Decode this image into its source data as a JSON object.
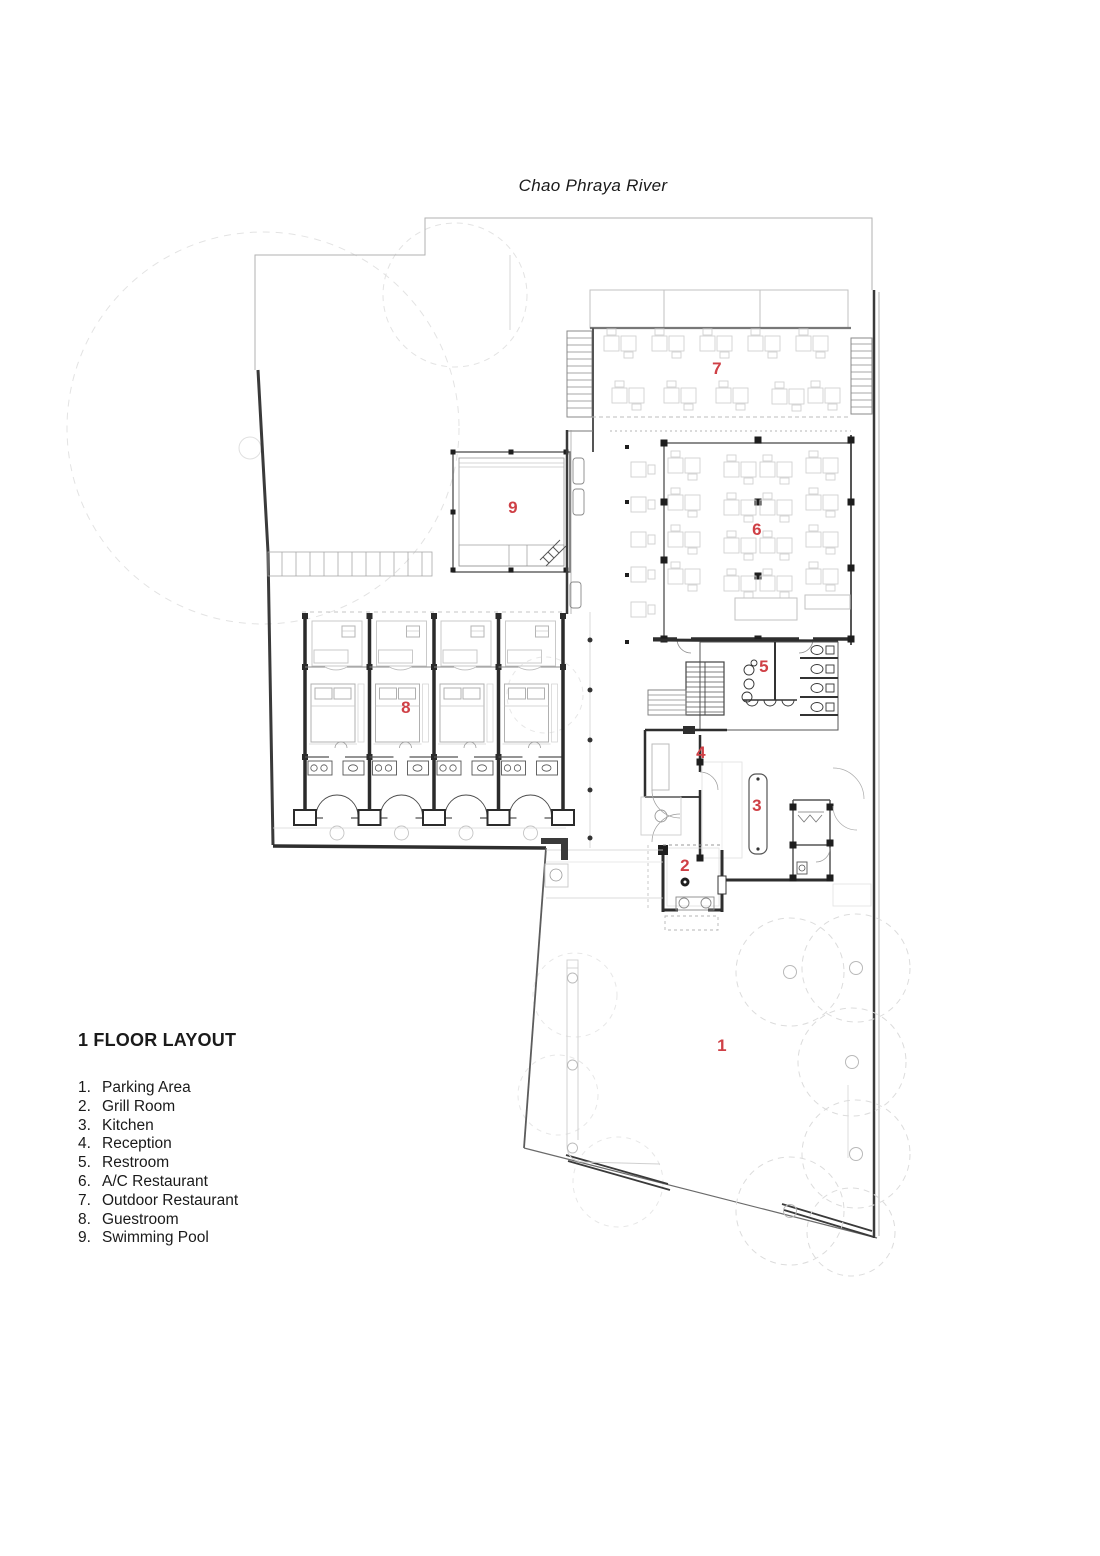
{
  "title": {
    "text": "Chao Phraya River"
  },
  "legend": {
    "heading": "1 FLOOR LAYOUT",
    "items": [
      {
        "num": "1.",
        "label": "Parking Area"
      },
      {
        "num": "2.",
        "label": "Grill Room"
      },
      {
        "num": "3.",
        "label": "Kitchen"
      },
      {
        "num": "4.",
        "label": "Reception"
      },
      {
        "num": "5.",
        "label": "Restroom"
      },
      {
        "num": "6.",
        "label": "A/C Restaurant"
      },
      {
        "num": "7.",
        "label": "Outdoor Restaurant"
      },
      {
        "num": "8.",
        "label": "Guestroom"
      },
      {
        "num": "9.",
        "label": "Swimming Pool"
      }
    ]
  },
  "plan": {
    "label_color": "#cf4046",
    "labels": [
      {
        "id": "1",
        "name": "Parking Area",
        "x": 722,
        "y": 1046
      },
      {
        "id": "2",
        "name": "Grill Room",
        "x": 685,
        "y": 866
      },
      {
        "id": "3",
        "name": "Kitchen",
        "x": 757,
        "y": 806
      },
      {
        "id": "4",
        "name": "Reception",
        "x": 701,
        "y": 753
      },
      {
        "id": "5",
        "name": "Restroom",
        "x": 764,
        "y": 667
      },
      {
        "id": "6",
        "name": "A/C Restaurant",
        "x": 757,
        "y": 530
      },
      {
        "id": "7",
        "name": "Outdoor Restaurant",
        "x": 717,
        "y": 369
      },
      {
        "id": "8",
        "name": "Guestroom",
        "x": 406,
        "y": 708
      },
      {
        "id": "9",
        "name": "Swimming Pool",
        "x": 513,
        "y": 508
      }
    ]
  }
}
